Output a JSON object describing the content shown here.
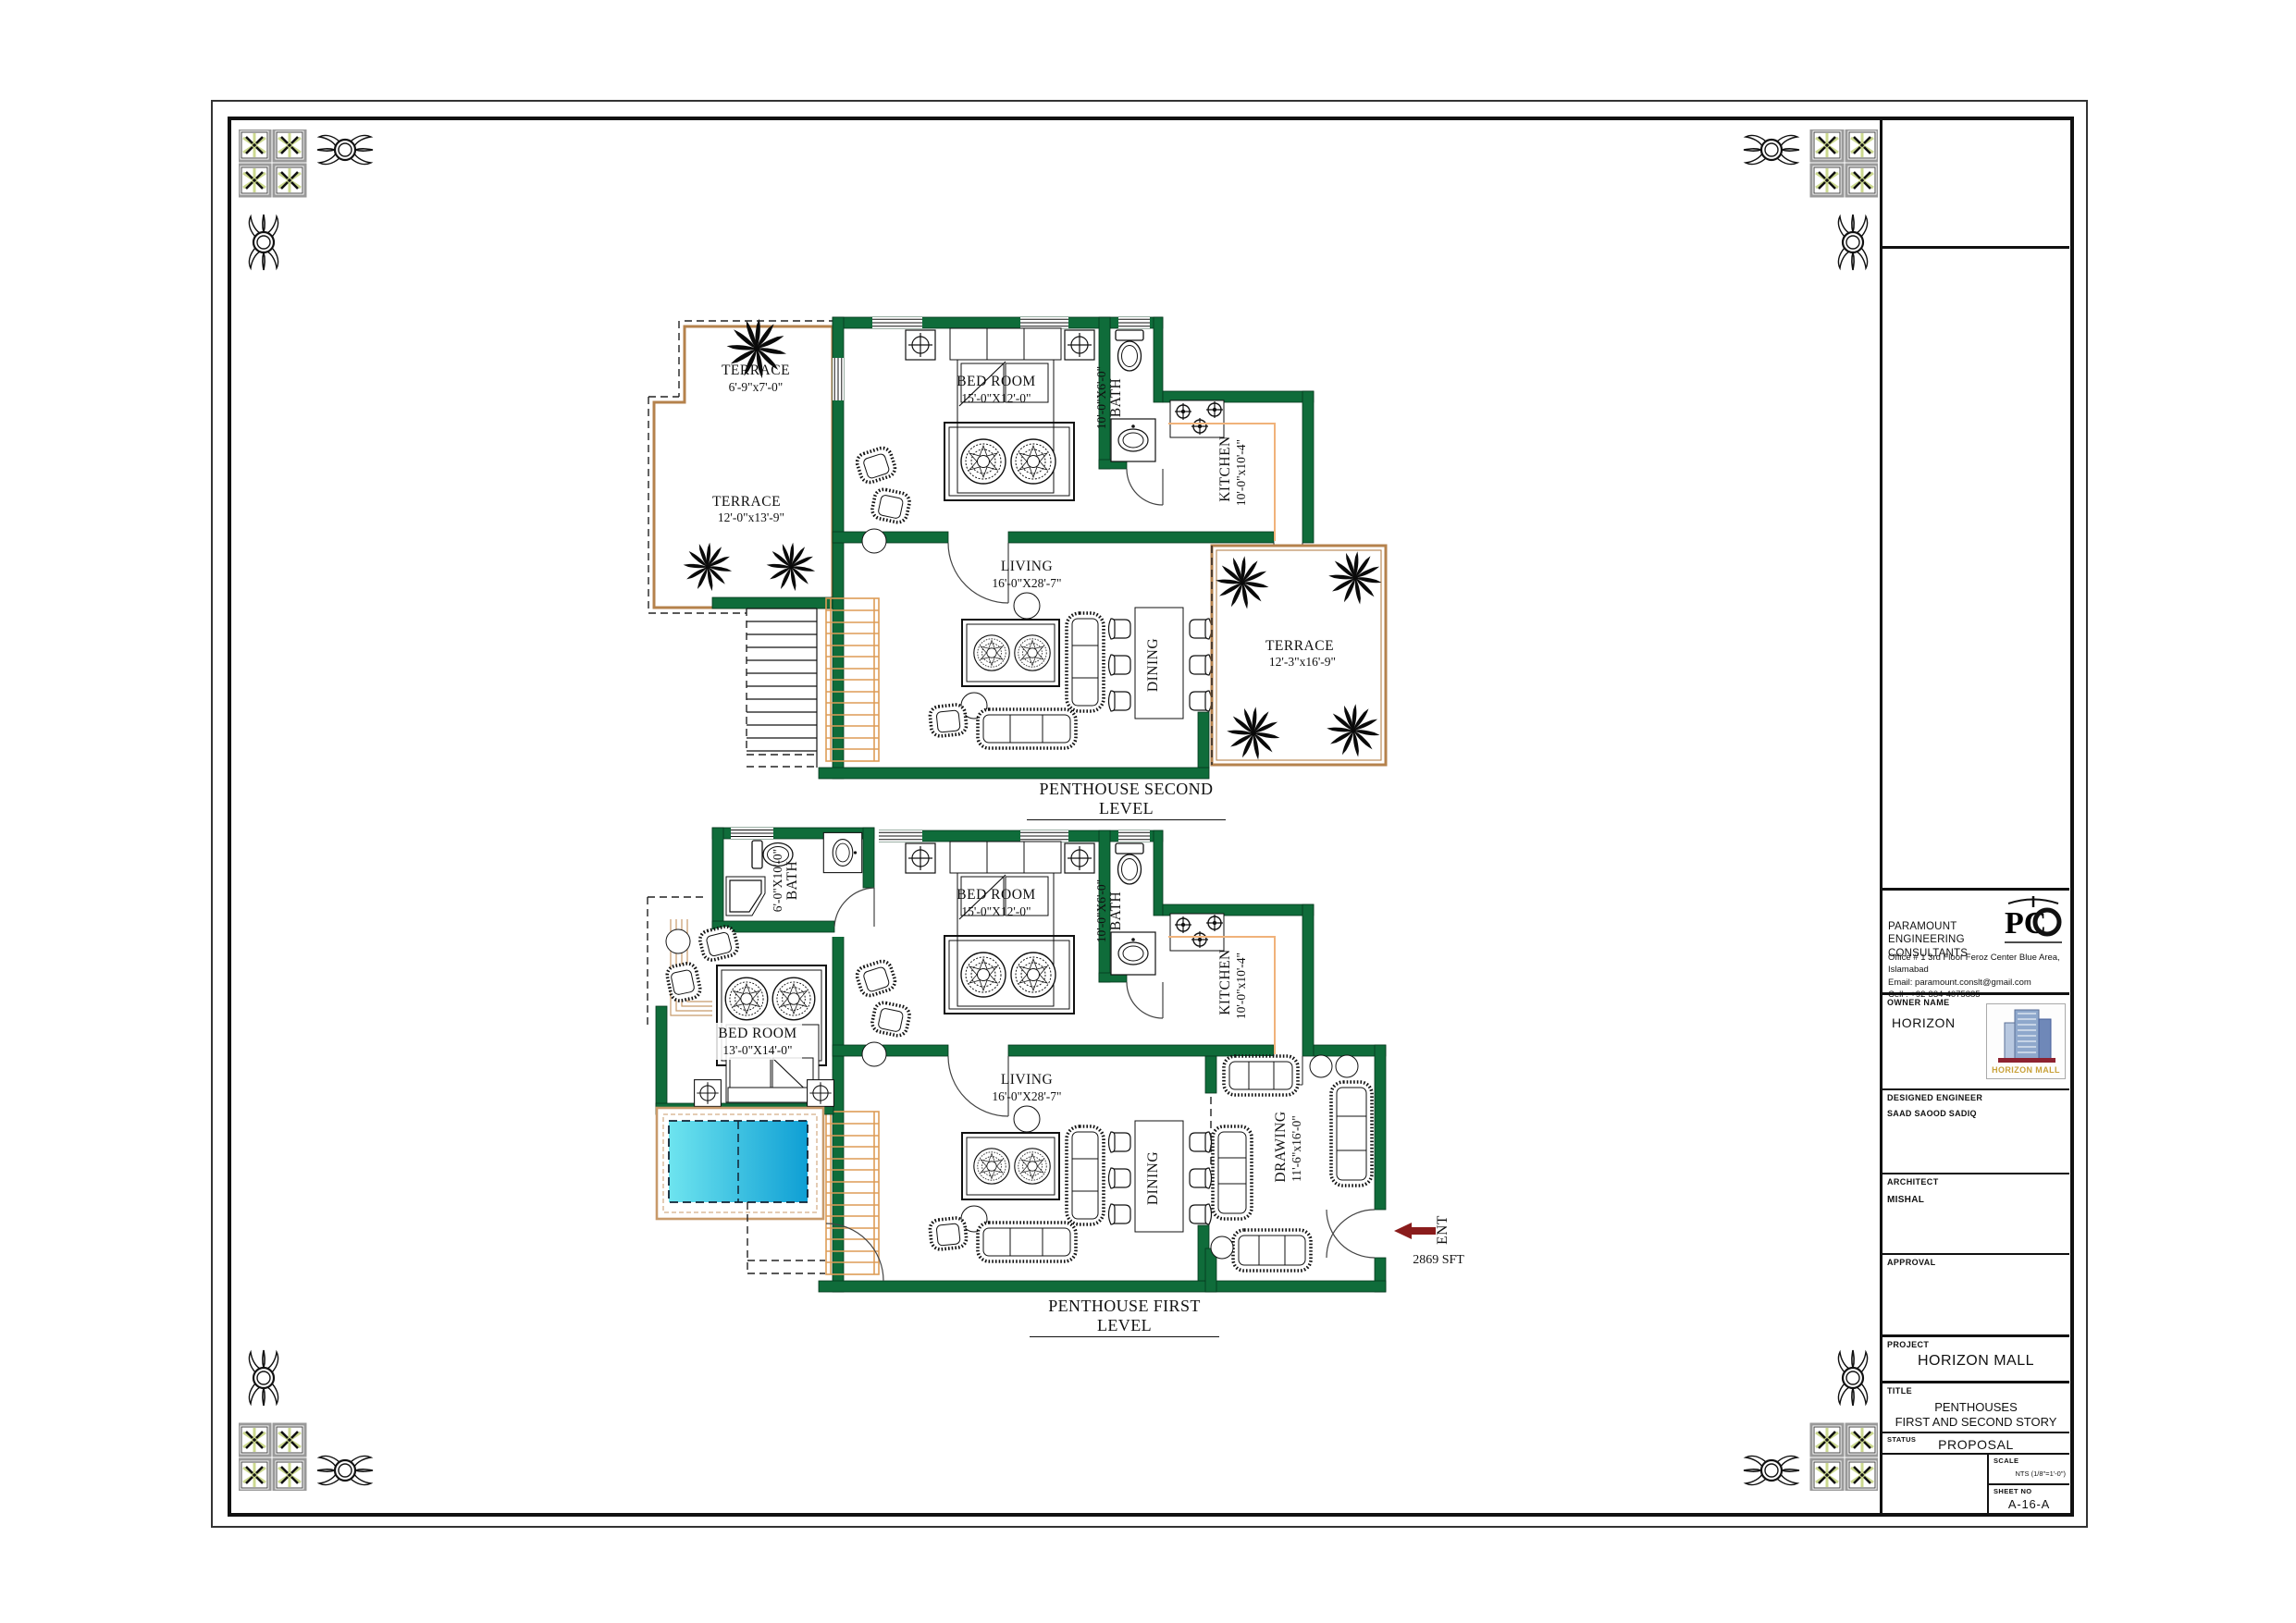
{
  "plans": {
    "second": {
      "caption": "PENTHOUSE SECOND LEVEL",
      "terrace1": {
        "name": "TERRACE",
        "dims": "6'-9\"x7'-0\""
      },
      "terrace2": {
        "name": "TERRACE",
        "dims": "12'-0\"x13'-9\""
      },
      "bedroom": {
        "name": "BED ROOM",
        "dims": "15'-0\"X12'-0\""
      },
      "bath": {
        "name": "BATH",
        "dims": "10'-0\"X6'-0\""
      },
      "kitchen": {
        "name": "KITCHEN",
        "dims": "10'-0\"x10'-4\""
      },
      "living": {
        "name": "LIVING",
        "dims": "16'-0\"X28'-7\""
      },
      "dining": {
        "name": "DINING"
      },
      "terrace3": {
        "name": "TERRACE",
        "dims": "12'-3\"x16'-9\""
      }
    },
    "first": {
      "caption": "PENTHOUSE FIRST LEVEL",
      "bath1": {
        "name": "BATH",
        "dims": "6'-0\"X10'-0\""
      },
      "bedroom1": {
        "name": "BED ROOM",
        "dims": "15'-0\"X12'-0\""
      },
      "bath2": {
        "name": "BATH",
        "dims": "10'-0\"X6'-0\""
      },
      "kitchen": {
        "name": "KITCHEN",
        "dims": "10'-0\"x10'-4\""
      },
      "bedroom2": {
        "name": "BED ROOM",
        "dims": "13'-0\"X14'-0\""
      },
      "living": {
        "name": "LIVING",
        "dims": "16'-0\"X28'-7\""
      },
      "dining": {
        "name": "DINING"
      },
      "drawing": {
        "name": "DRAWING",
        "dims": "11'-6\"x16'-0\""
      },
      "entrance": {
        "label": "ENT",
        "area": "2869 SFT"
      }
    }
  },
  "titleblock": {
    "company_line1": "PARAMOUNT ENGINEERING",
    "company_line2": "CONSULTANTS",
    "office": "Office # 1 3rd Floor Feroz Center Blue Area, Islamabad",
    "email": "Email: paramount.conslt@gmail.com",
    "cell": "Cell : +92-334-4075885",
    "logo_monogram": "PC",
    "owner_label": "OWNER NAME",
    "owner_name": "HORIZON",
    "owner_logo_text": "HORIZON MALL",
    "engineer_label": "DESIGNED ENGINEER",
    "engineer_name": "SAAD SAOOD SADIQ",
    "architect_label": "ARCHITECT",
    "architect_name": "MISHAL",
    "approval_label": "APPROVAL",
    "project_label": "PROJECT",
    "project_name": "HORIZON MALL",
    "title_label": "TITLE",
    "title_line1": "PENTHOUSES",
    "title_line2": "FIRST AND SECOND STORY",
    "status_label": "STATUS",
    "status_value": "PROPOSAL",
    "scale_label": "SCALE",
    "scale_value": "NTS (1/8\"=1'-0\")",
    "sheet_label": "SHEET NO",
    "sheet_value": "A-16-A"
  },
  "colors": {
    "wall_green": "#0f6c3a",
    "terrace_tan": "#b5824c",
    "stair_orange": "#dd9c57",
    "pool_light": "#6ee4ef",
    "pool_dark": "#0f9fd4",
    "entry_arrow_red": "#8a1c1c",
    "ornament_star_green": "#ccd98f",
    "logo_gold": "#c9a23a"
  }
}
